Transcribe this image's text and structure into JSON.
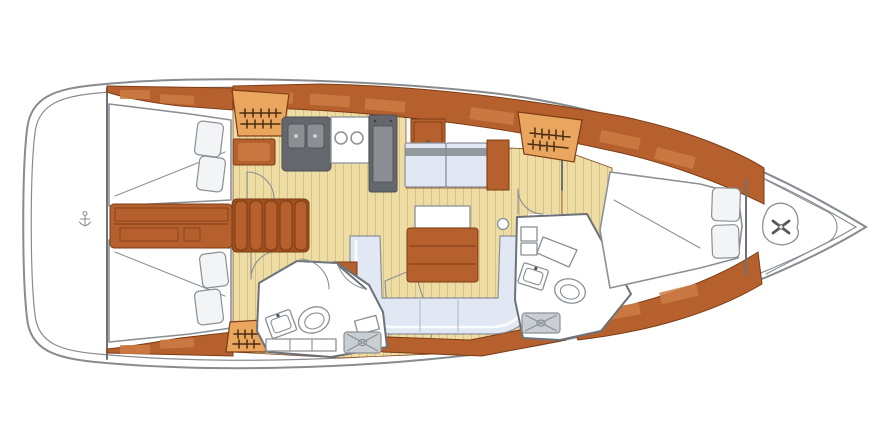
{
  "figure": {
    "title": "Sailing yacht interior floor plan (top view, bow to the right)",
    "type": "floor-plan"
  },
  "rooms": [
    {
      "id": "transom-lazarette",
      "label": "Transom / lazarette"
    },
    {
      "id": "aft-cabin-port",
      "label": "Aft cabin (port)"
    },
    {
      "id": "aft-cabin-starboard",
      "label": "Aft cabin (starboard)"
    },
    {
      "id": "engine-compartment",
      "label": "Engine compartment"
    },
    {
      "id": "companionway",
      "label": "Companionway steps"
    },
    {
      "id": "galley",
      "label": "Galley"
    },
    {
      "id": "nav-station",
      "label": "Chart table / nav station"
    },
    {
      "id": "salon",
      "label": "Saloon with U-settee and table"
    },
    {
      "id": "aft-head",
      "label": "Aft head (bathroom)"
    },
    {
      "id": "forward-head",
      "label": "Forward head (bathroom)"
    },
    {
      "id": "forward-cabin",
      "label": "Forward cabin"
    },
    {
      "id": "anchor-locker",
      "label": "Bow anchor locker with windlass"
    }
  ],
  "colors": {
    "bg": "#ffffff",
    "hull_line": "#878c91",
    "wood": "#b6602e",
    "wood_dark": "#a0501f",
    "wood_light": "#cd7c44",
    "wood_edge": "#7c3d16",
    "floor": "#eddca3",
    "floor_line": "#d9c083",
    "locker": "#eaa55f",
    "upholstery": "#e1e8f4",
    "upholstery_line": "#aab6c6",
    "pillow": "#f3f4f6",
    "appliance": "#64686c",
    "appliance_light": "#8b8f93",
    "locker_gray": "#c9ced3",
    "fixture_line": "#8a9096",
    "wall": "#6c7278",
    "hanger": "#4a2c12",
    "mark_dark": "#55595d"
  }
}
